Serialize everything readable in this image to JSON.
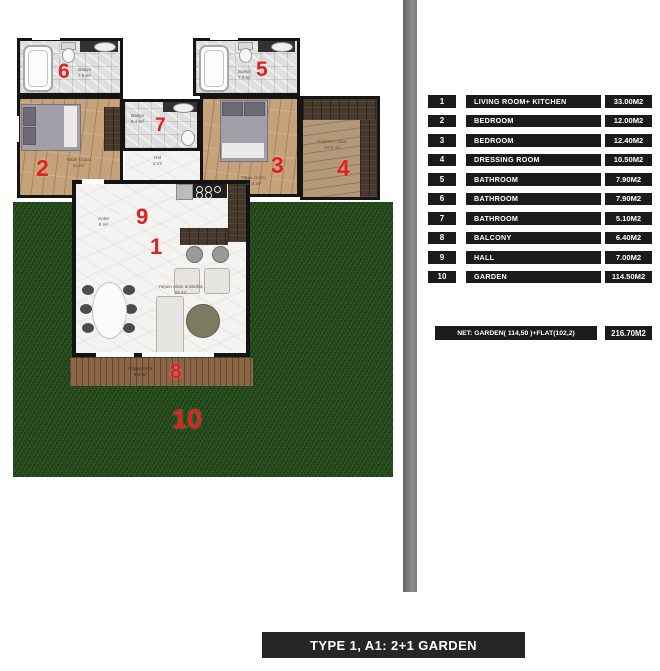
{
  "plan": {
    "rooms": {
      "bath6": {
        "num": "6",
        "name": "Banyo",
        "area": "7.9 m²"
      },
      "bath5": {
        "num": "5",
        "name": "Banyo",
        "area": "7.9 m²"
      },
      "bath7": {
        "num": "7",
        "name": "Banyo",
        "area": "5.1 m²"
      },
      "bed2": {
        "num": "2",
        "name": "Yatak Odası",
        "area": "12 m²"
      },
      "bed3": {
        "num": "3",
        "name": "Yatak Odası",
        "area": "12.4 m²"
      },
      "dress4": {
        "num": "4",
        "name": "Giyinme Odası",
        "area": "10.5 m²"
      },
      "hall9": {
        "num": "9",
        "name": "Antre",
        "area": "8 m²"
      },
      "hol": {
        "name": "Hol",
        "area": "2 m²"
      },
      "living1": {
        "num": "1",
        "name": "Yaşam Alanı & Mutfak",
        "area": "33 m²"
      },
      "deck8": {
        "num": "8",
        "name": "Ahşap Deck",
        "area": "6.4 m²"
      },
      "garden10": {
        "num": "10"
      }
    }
  },
  "legend": {
    "rows": [
      {
        "num": "1",
        "name": "LIVING ROOM+ KITCHEN",
        "area": "33.00M2"
      },
      {
        "num": "2",
        "name": "BEDROOM",
        "area": "12.00M2"
      },
      {
        "num": "3",
        "name": "BEDROOM",
        "area": "12.40M2"
      },
      {
        "num": "4",
        "name": "DRESSING ROOM",
        "area": "10.50M2"
      },
      {
        "num": "5",
        "name": "BATHROOM",
        "area": "7.90M2"
      },
      {
        "num": "6",
        "name": "BATHROOM",
        "area": "7.90M2"
      },
      {
        "num": "7",
        "name": "BATHROOM",
        "area": "5.10M2"
      },
      {
        "num": "8",
        "name": "BALCONY",
        "area": "6.40M2"
      },
      {
        "num": "9",
        "name": "HALL",
        "area": "7.00M2"
      },
      {
        "num": "10",
        "name": "GARDEN",
        "area": "114.50M2"
      }
    ],
    "net": {
      "label": "NET: GARDEN( 114,50 )+FLAT(102,2)",
      "area": "216.70M2"
    }
  },
  "footer": {
    "title": "TYPE 1, A1: 2+1 GARDEN"
  },
  "colors": {
    "accent_red": "#e2201d",
    "table_bg": "#1b1b1b",
    "grass": "#2a5220",
    "deck": "#8b6547",
    "wood": "#c6a27b",
    "dark_wood": "#46392b",
    "tile": "#e0dfdf",
    "marble": "#f4f3f1",
    "divider": "#7d7d7d",
    "wall": "#141414"
  }
}
